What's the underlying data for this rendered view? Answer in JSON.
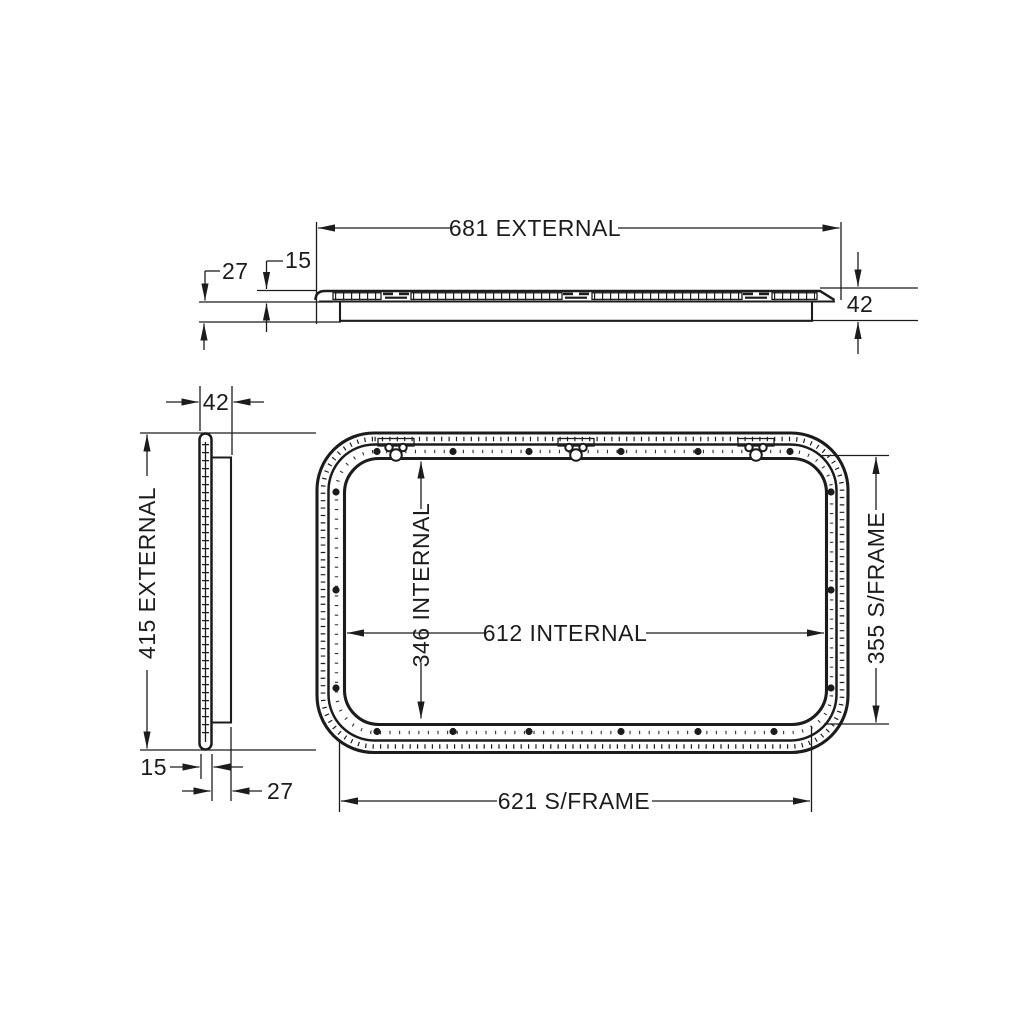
{
  "views": {
    "top_profile": {
      "width_label": "681 EXTERNAL",
      "lip_label": "27",
      "flange_label": "15",
      "depth_label": "42"
    },
    "side_profile": {
      "depth_label": "42",
      "height_label": "415 EXTERNAL",
      "flange_label": "15",
      "lip_label": "27"
    },
    "front": {
      "internal_height_label": "346 INTERNAL",
      "internal_width_label": "612 INTERNAL",
      "subframe_height_label": "355 S/FRAME",
      "subframe_width_label": "621 S/FRAME"
    }
  },
  "style": {
    "line_color": "#1c1c1c",
    "background": "#ffffff"
  }
}
